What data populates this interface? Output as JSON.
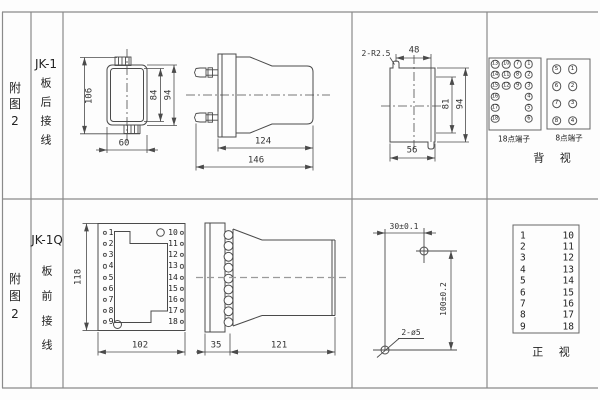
{
  "row1": {
    "figure_label": {
      "char1": "附",
      "char2": "图",
      "char3": "2"
    },
    "model": "JK-1",
    "wiring": {
      "char1": "板",
      "char2": "后",
      "char3": "接",
      "char4": "线"
    },
    "rear_view": {
      "dim_total_height": "106",
      "dim_inner_height": "84",
      "dim_outer_height": "94",
      "dim_width": "60"
    },
    "side_view": {
      "dim_body_length": "124",
      "dim_total_length": "146"
    },
    "panel_cutout": {
      "slot_note": "2-R2.5",
      "dim_slot_span": "48",
      "dim_inner_height": "81",
      "dim_outer_height": "94",
      "dim_width": "56"
    },
    "rear_terminals": {
      "block18": {
        "label": "18点端子",
        "grid": [
          [
            "13",
            "10",
            "7",
            "1"
          ],
          [
            "14",
            "11",
            "8",
            "2"
          ],
          [
            "15",
            "12",
            "9",
            "3"
          ],
          [
            "16",
            "",
            "",
            "4"
          ],
          [
            "17",
            "",
            "",
            "5"
          ],
          [
            "18",
            "",
            "",
            "6"
          ]
        ]
      },
      "block8": {
        "label": "8点端子",
        "grid": [
          [
            "5",
            "1"
          ],
          [
            "6",
            "2"
          ],
          [
            "7",
            "3"
          ],
          [
            "8",
            "4"
          ]
        ]
      },
      "view_label": "背 视"
    }
  },
  "row2": {
    "figure_label": {
      "char1": "附",
      "char2": "图",
      "char3": "2"
    },
    "model": "JK-1Q",
    "wiring": {
      "char1": "板",
      "char2": "前",
      "char3": "接",
      "char4": "线"
    },
    "front_view": {
      "dim_height": "118",
      "dim_width": "102",
      "left_terminals": [
        "1",
        "2",
        "3",
        "4",
        "5",
        "6",
        "7",
        "8",
        "9"
      ],
      "right_terminals": [
        "10",
        "11",
        "12",
        "13",
        "14",
        "15",
        "16",
        "17",
        "18"
      ]
    },
    "side_view": {
      "dim_flange": "35",
      "dim_body_length": "121"
    },
    "drill_plan": {
      "dim_horizontal": "30±0.1",
      "dim_vertical": "100±0.2",
      "hole_note": "2-ø5"
    },
    "front_terminals": {
      "left": [
        "1",
        "2",
        "3",
        "4",
        "5",
        "6",
        "7",
        "8",
        "9"
      ],
      "right": [
        "10",
        "11",
        "12",
        "13",
        "14",
        "15",
        "16",
        "17",
        "18"
      ],
      "view_label": "正 视"
    }
  }
}
